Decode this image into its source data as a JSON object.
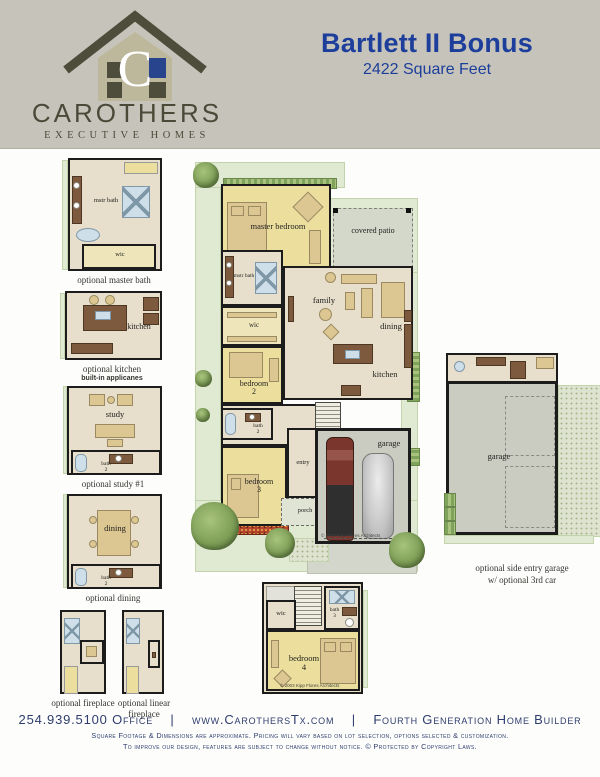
{
  "header": {
    "logo_letter": "C",
    "brand": "CAROTHERS",
    "brand_sub": "EXECUTIVE HOMES",
    "plan_name": "Bartlett II Bonus",
    "plan_sqft": "2422 Square Feet"
  },
  "optional_plans": {
    "master_bath": {
      "caption": "optional master bath",
      "rooms": {
        "mstr_bath": "mstr bath",
        "wic": "wic"
      }
    },
    "kitchen": {
      "caption": "optional kitchen",
      "caption2": "built-in applicanes",
      "rooms": {
        "kitchen": "kitchen"
      }
    },
    "study": {
      "caption": "optional study #1",
      "rooms": {
        "study": "study",
        "bath": "bath",
        "bath_num": "2"
      }
    },
    "dining": {
      "caption": "optional dining",
      "rooms": {
        "dining": "dining",
        "bath": "bath",
        "bath_num": "2"
      }
    },
    "fireplace": {
      "caption": "optional fireplace"
    },
    "linear_fireplace": {
      "caption": "optional linear fireplace"
    },
    "side_garage": {
      "caption": "optional side entry garage",
      "caption2": "w/ optional 3rd car",
      "rooms": {
        "garage": "garage"
      }
    }
  },
  "main_plan": {
    "rooms": {
      "master_bedroom": "master bedroom",
      "covered_patio": "covered patio",
      "mstr_bath": "mstr bath",
      "wic": "wic",
      "family": "family",
      "dining": "dining",
      "kitchen": "kitchen",
      "bedroom2": "bedroom",
      "bedroom2_num": "2",
      "bath2": "bath",
      "bath2_num": "2",
      "bedroom3": "bedroom",
      "bedroom3_num": "3",
      "entry": "entry",
      "porch": "porch",
      "garage": "garage"
    },
    "copyright": "© 2003 Kipp Flores Architects"
  },
  "bonus_floor": {
    "rooms": {
      "wic": "wic",
      "bath": "bath",
      "bath_num": "3",
      "bedroom": "bedroom",
      "bedroom_num": "4"
    },
    "copyright": "© 2003 Kipp Flores Architects"
  },
  "footer": {
    "phone": "254.939.5100 Office",
    "divider": "|",
    "website": "www.CarothersTx.com",
    "tagline": "Fourth Generation Home Builder",
    "disclaimer_line1": "Square Footage & Dimensions are approximate.  Pricing will vary based on lot selection, options selected & customization.",
    "disclaimer_line2": "To improve our design, features are subject to change without notice.  © Protected by Copyright Laws."
  },
  "colors": {
    "header_bg": "#c6c4ba",
    "title_blue": "#1d3e9b",
    "footer_navy": "#2e3d6d",
    "logo_olive": "#4e4d3b",
    "logo_tan": "#bdb79b",
    "logo_blue": "#27448c",
    "room_yellow": "#ecdf9e",
    "room_beige": "#e7decb",
    "patio_gray": "#d3d8ca",
    "garage_gray": "#caccc1",
    "landscape_green": "#e0e9d2",
    "wall_black": "#1c1c1c",
    "wood_brown": "#7d5a3e",
    "fixture_blue": "#cfdfe9"
  }
}
